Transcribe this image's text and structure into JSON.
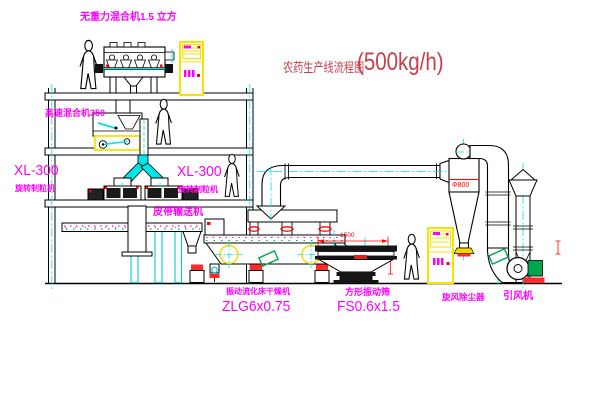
{
  "title": {
    "text": "农药生产线流程图",
    "capacity": "(500kg/h)"
  },
  "labels": {
    "gravity_free_mixer": "无重力混合机1.5 立方",
    "high_speed_mixer": "高速混合机350",
    "xl300_left": "XL-300",
    "rotary_granulator_left": "旋转制粒机",
    "xl300_right": "XL-300",
    "rotary_granulator_right": "旋转制粒机",
    "belt_conveyor": "皮带输送机",
    "fluid_bed_dryer": "振动流化床干燥机",
    "fluid_bed_dryer_model": "ZLG6x0.75",
    "square_vibrating_sieve": "方形振动筛",
    "square_vibrating_sieve_model": "FS0.6x1.5",
    "cyclone_dust_collector": "旋风除尘器",
    "induced_draft_fan": "引风机"
  },
  "dimensions": {
    "cyclone_diameter": "Φ800",
    "sieve_length": "1500"
  },
  "colors": {
    "label_magenta": "#FF00FF",
    "title_red": "#C5404A",
    "dimension_red": "#FF0000",
    "centerline_cyan": "#00E5E5",
    "cabinet_yellow": "#F5E400",
    "machine_green": "#00A550"
  }
}
